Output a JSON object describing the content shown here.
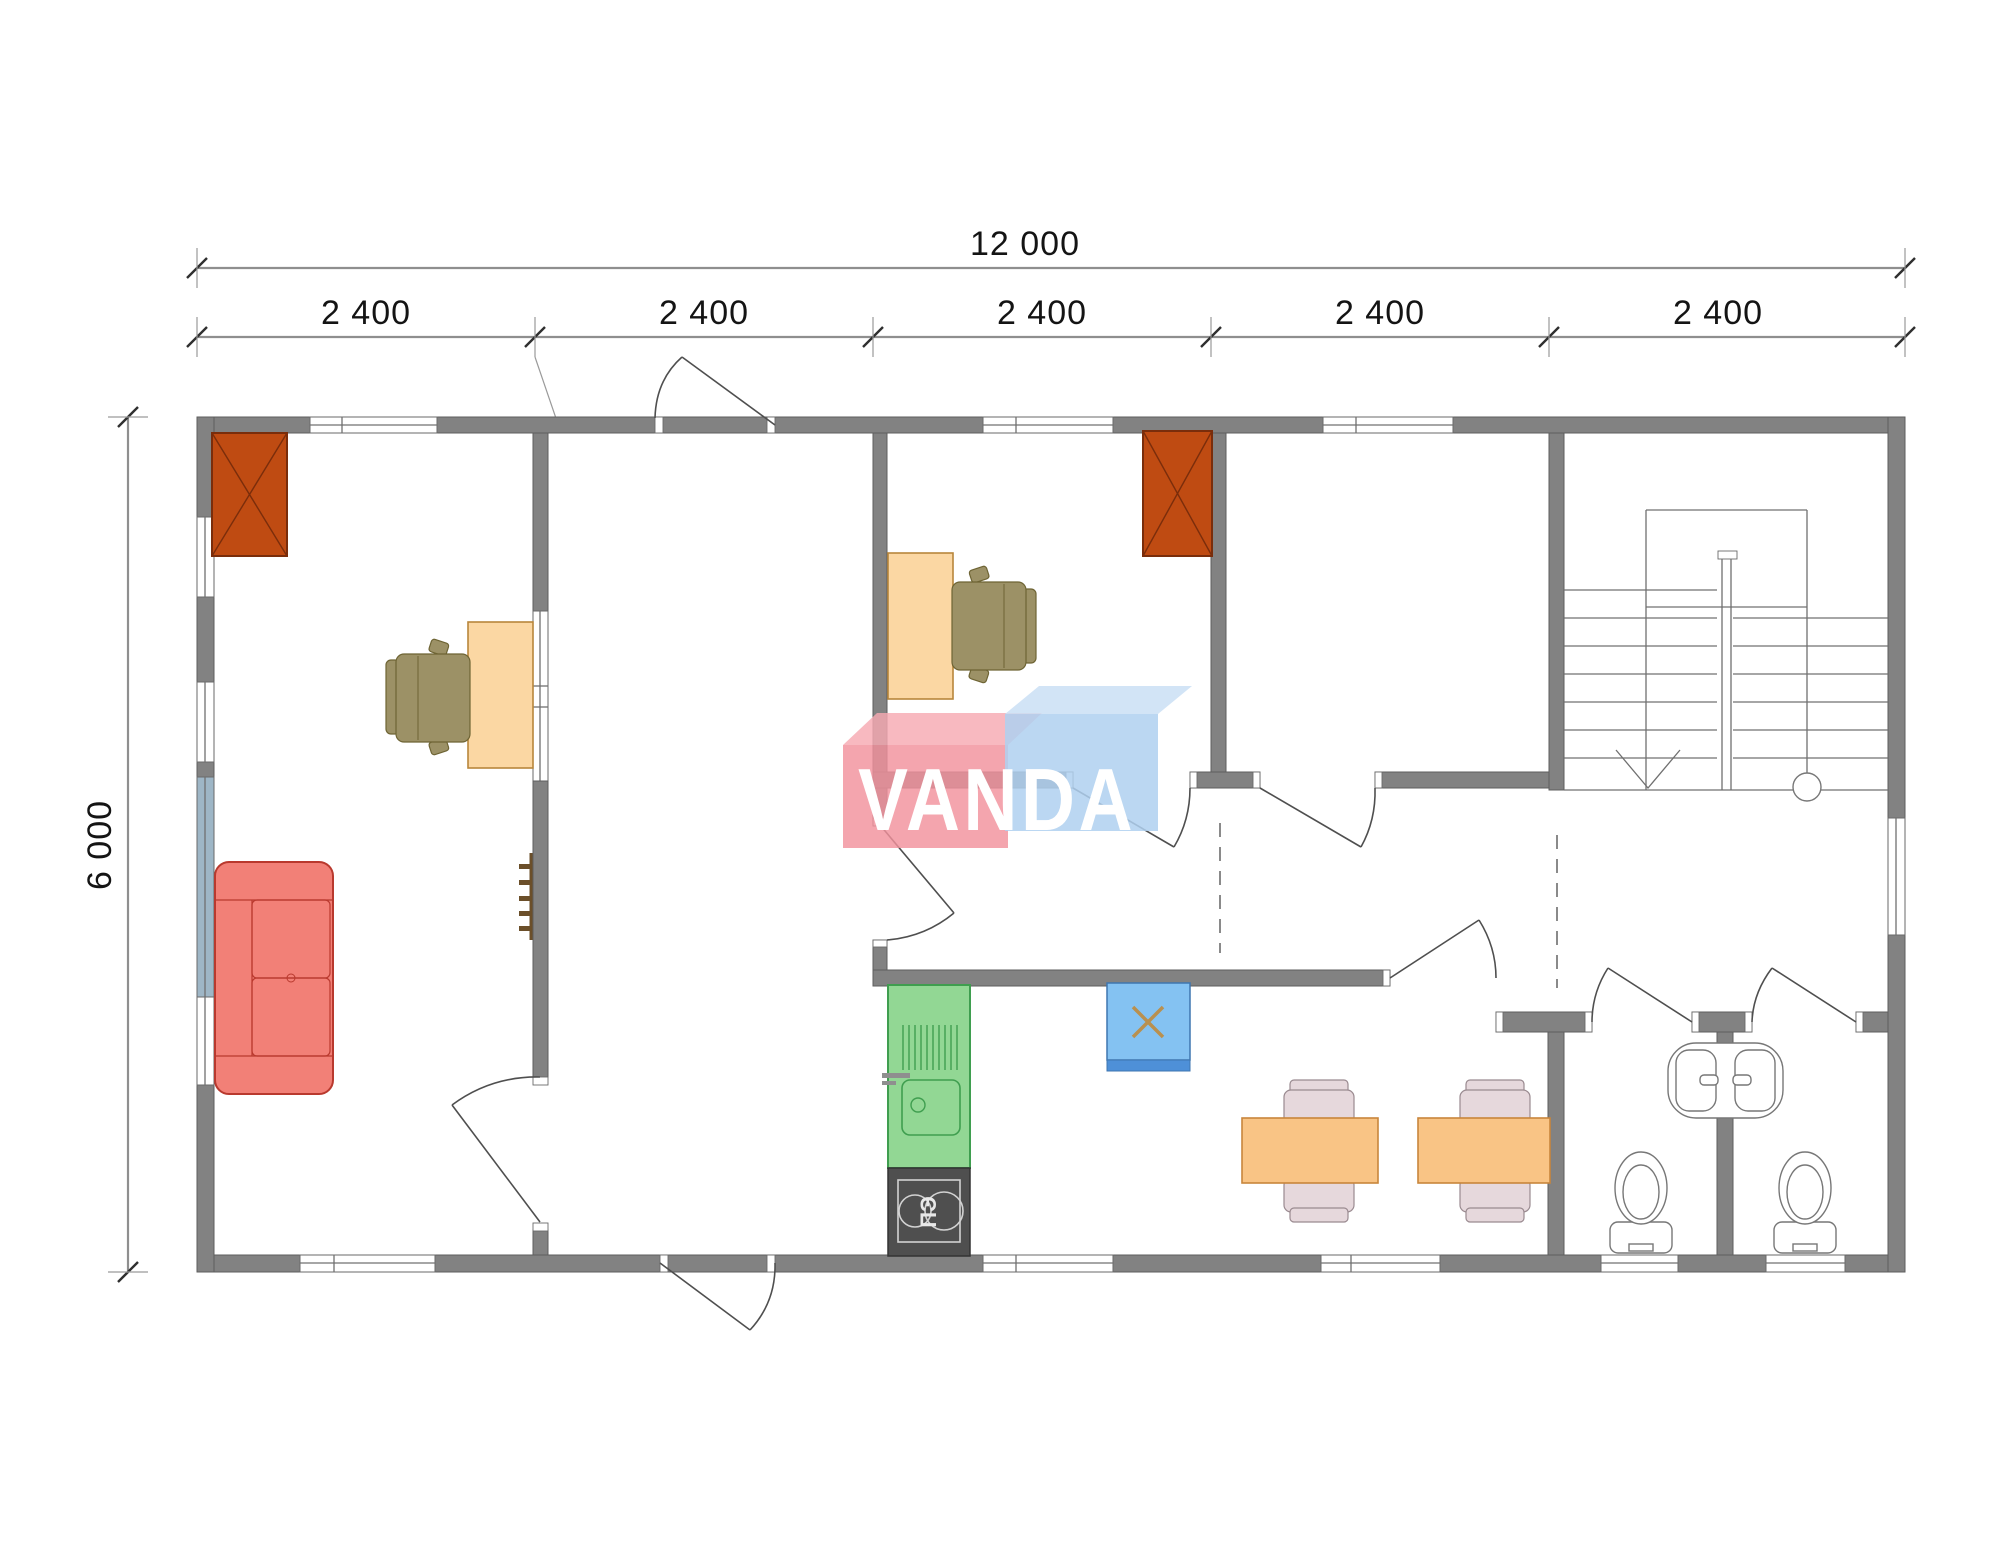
{
  "dimensions": {
    "total": "12 000",
    "height": "6 000",
    "segments": [
      "2 400",
      "2 400",
      "2 400",
      "2 400",
      "2 400"
    ]
  },
  "watermark": {
    "text": "VANDA",
    "pink_box_color": "#F2919C",
    "blue_box_color": "#AFD0F0",
    "text_color": "#FFFFFF"
  },
  "appliances": {
    "stove_label": "ПЭ"
  },
  "colors": {
    "wall": "#828282",
    "chimney": "#BF4B12",
    "sofa": "#F28077",
    "desk": "#FBD7A3",
    "office_chair": "#9C9166",
    "kitchen_counter": "#92D794",
    "stove": "#4F4F4F",
    "boiler": "#84C2F2",
    "boiler_band": "#4E90D8",
    "boiler_mark": "#B9904F",
    "dining_table": "#F9C485",
    "dining_chair": "#E6D8DC",
    "window_glass_panel": "#9EB6C6",
    "hooks": "#6B4F2A"
  }
}
